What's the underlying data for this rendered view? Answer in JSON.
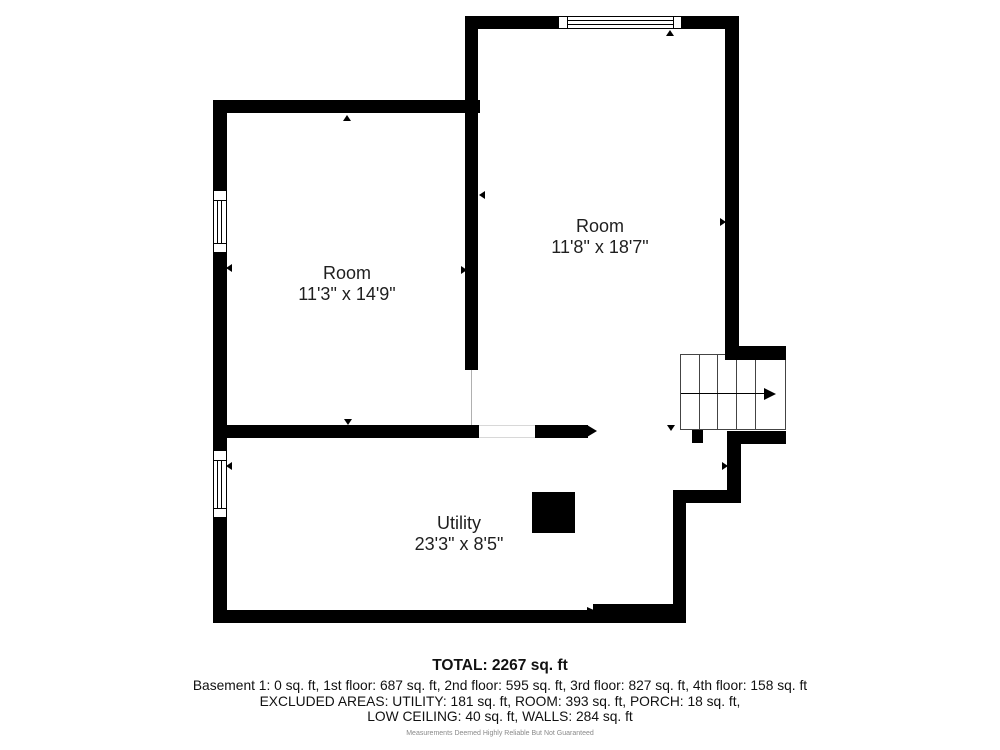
{
  "colors": {
    "wall": "#000000",
    "text": "#1f1f1f",
    "stair_line": "#444444",
    "opening_line": "#d8d8d8",
    "disclaimer": "#8a8a8a",
    "background": "#ffffff"
  },
  "rooms": [
    {
      "name": "Room",
      "dimensions": "11'3\" x 14'9\""
    },
    {
      "name": "Room",
      "dimensions": "11'8\" x 18'7\""
    },
    {
      "name": "Utility",
      "dimensions": "23'3\" x 8'5\""
    }
  ],
  "summary": {
    "total": "TOTAL: 2267 sq. ft",
    "floors": "Basement 1: 0 sq. ft, 1st floor: 687 sq. ft, 2nd floor: 595 sq. ft, 3rd floor: 827 sq. ft, 4th floor: 158 sq. ft",
    "excluded_line1": "EXCLUDED AREAS: UTILITY: 181 sq. ft, ROOM: 393 sq. ft, PORCH: 18 sq. ft,",
    "excluded_line2": "LOW CEILING: 40 sq. ft, WALLS: 284 sq. ft",
    "disclaimer": "Measurements Deemed Highly Reliable But Not Guaranteed"
  },
  "plan": {
    "rects": [
      {
        "name": "wall-left-upper",
        "x": 213,
        "y": 100,
        "w": 14,
        "h": 90,
        "c": "#000000"
      },
      {
        "name": "wall-left-mid",
        "x": 213,
        "y": 253,
        "w": 14,
        "h": 197,
        "c": "#000000"
      },
      {
        "name": "wall-left-lower",
        "x": 213,
        "y": 518,
        "w": 14,
        "h": 105,
        "c": "#000000"
      },
      {
        "name": "wall-top-left-room",
        "x": 213,
        "y": 100,
        "w": 267,
        "h": 13,
        "c": "#000000"
      },
      {
        "name": "wall-middle-vertical",
        "x": 465,
        "y": 16,
        "w": 13,
        "h": 354,
        "c": "#000000"
      },
      {
        "name": "wall-top-right-room-left",
        "x": 465,
        "y": 16,
        "w": 93,
        "h": 13,
        "c": "#000000"
      },
      {
        "name": "wall-top-right-room-right",
        "x": 682,
        "y": 16,
        "w": 56,
        "h": 13,
        "c": "#000000"
      },
      {
        "name": "wall-right",
        "x": 725,
        "y": 16,
        "w": 14,
        "h": 344,
        "c": "#000000"
      },
      {
        "name": "wall-divider-left",
        "x": 213,
        "y": 425,
        "w": 266,
        "h": 13,
        "c": "#000000"
      },
      {
        "name": "wall-divider-right",
        "x": 535,
        "y": 425,
        "w": 53,
        "h": 13,
        "c": "#000000"
      },
      {
        "name": "wall-right-below-stairs",
        "x": 727,
        "y": 431,
        "w": 14,
        "h": 72,
        "c": "#000000"
      },
      {
        "name": "wall-jog-horizontal",
        "x": 673,
        "y": 490,
        "w": 68,
        "h": 13,
        "c": "#000000"
      },
      {
        "name": "wall-right-lower",
        "x": 673,
        "y": 490,
        "w": 13,
        "h": 133,
        "c": "#000000"
      },
      {
        "name": "wall-bottom",
        "x": 213,
        "y": 610,
        "w": 473,
        "h": 13,
        "c": "#000000"
      },
      {
        "name": "wall-bottom-step",
        "x": 593,
        "y": 604,
        "w": 80,
        "h": 8,
        "c": "#000000"
      },
      {
        "name": "door-opening-edge-top",
        "x": 479,
        "y": 425,
        "w": 56,
        "h": 1,
        "c": "#d8d8d8"
      },
      {
        "name": "door-opening-edge-bottom",
        "x": 479,
        "y": 437,
        "w": 56,
        "h": 1,
        "c": "#d8d8d8"
      },
      {
        "name": "wall-opening-line",
        "x": 471,
        "y": 370,
        "w": 1,
        "h": 55,
        "c": "#b0b0b0"
      },
      {
        "name": "stairs-floor",
        "x": 680,
        "y": 354,
        "w": 106,
        "h": 76,
        "c": "#ffffff",
        "border": "#444444"
      },
      {
        "name": "stair-tread-line",
        "x": 699,
        "y": 354,
        "w": 1,
        "h": 76,
        "c": "#444444"
      },
      {
        "name": "stair-tread-line",
        "x": 717,
        "y": 354,
        "w": 1,
        "h": 76,
        "c": "#444444"
      },
      {
        "name": "stair-tread-line",
        "x": 736,
        "y": 354,
        "w": 1,
        "h": 76,
        "c": "#444444"
      },
      {
        "name": "stair-tread-line",
        "x": 755,
        "y": 354,
        "w": 1,
        "h": 76,
        "c": "#444444"
      },
      {
        "name": "stair-direction-line",
        "x": 681,
        "y": 393,
        "w": 83,
        "h": 1,
        "c": "#000000"
      },
      {
        "name": "wall-stairwell-top",
        "x": 725,
        "y": 346,
        "w": 61,
        "h": 14,
        "c": "#000000"
      },
      {
        "name": "wall-stairwell-bottom",
        "x": 727,
        "y": 431,
        "w": 59,
        "h": 13,
        "c": "#000000"
      },
      {
        "name": "wall-stair-tab",
        "x": 692,
        "y": 430,
        "w": 11,
        "h": 13,
        "c": "#000000"
      },
      {
        "name": "chimney-block",
        "x": 532,
        "y": 492,
        "w": 43,
        "h": 41,
        "c": "#000000"
      },
      {
        "name": "window-top-frame",
        "x": 558,
        "y": 16,
        "w": 124,
        "h": 13,
        "c": "#ffffff",
        "border": "#000000"
      },
      {
        "name": "window-top-separator-left",
        "x": 567,
        "y": 16,
        "w": 1,
        "h": 13,
        "c": "#000000"
      },
      {
        "name": "window-top-separator-right",
        "x": 673,
        "y": 16,
        "w": 1,
        "h": 13,
        "c": "#000000"
      },
      {
        "name": "window-top-pane-line",
        "x": 567,
        "y": 20,
        "w": 107,
        "h": 1,
        "c": "#000000"
      },
      {
        "name": "window-top-pane-line",
        "x": 567,
        "y": 24,
        "w": 107,
        "h": 1,
        "c": "#000000"
      },
      {
        "name": "window-left-upper-frame",
        "x": 213,
        "y": 190,
        "w": 14,
        "h": 63,
        "c": "#ffffff",
        "border": "#000000"
      },
      {
        "name": "window-left-upper-separator",
        "x": 213,
        "y": 200,
        "w": 14,
        "h": 1,
        "c": "#000000"
      },
      {
        "name": "window-left-upper-separator",
        "x": 213,
        "y": 243,
        "w": 14,
        "h": 1,
        "c": "#000000"
      },
      {
        "name": "window-left-upper-pane-line",
        "x": 217,
        "y": 200,
        "w": 1,
        "h": 43,
        "c": "#000000"
      },
      {
        "name": "window-left-upper-pane-line",
        "x": 221,
        "y": 200,
        "w": 1,
        "h": 43,
        "c": "#000000"
      },
      {
        "name": "window-left-lower-frame",
        "x": 213,
        "y": 450,
        "w": 14,
        "h": 68,
        "c": "#ffffff",
        "border": "#000000"
      },
      {
        "name": "window-left-lower-separator",
        "x": 213,
        "y": 460,
        "w": 14,
        "h": 1,
        "c": "#000000"
      },
      {
        "name": "window-left-lower-separator",
        "x": 213,
        "y": 508,
        "w": 14,
        "h": 1,
        "c": "#000000"
      },
      {
        "name": "window-left-lower-pane-line",
        "x": 217,
        "y": 460,
        "w": 1,
        "h": 48,
        "c": "#000000"
      },
      {
        "name": "window-left-lower-pane-line",
        "x": 221,
        "y": 460,
        "w": 1,
        "h": 48,
        "c": "#000000"
      }
    ],
    "triangles": [
      {
        "name": "measure-arrow-up-left-room",
        "dir": "up",
        "tx": 347,
        "ty": 115,
        "w": 9,
        "h": 6
      },
      {
        "name": "measure-arrow-down-left-room",
        "dir": "down",
        "tx": 348,
        "ty": 425,
        "w": 9,
        "h": 6
      },
      {
        "name": "measure-arrow-left-left-room",
        "dir": "left",
        "tx": 226,
        "ty": 268,
        "w": 6,
        "h": 9
      },
      {
        "name": "measure-arrow-right-left-room",
        "dir": "right",
        "tx": 467,
        "ty": 270,
        "w": 6,
        "h": 9
      },
      {
        "name": "measure-arrow-left-right-room",
        "dir": "left",
        "tx": 479,
        "ty": 195,
        "w": 6,
        "h": 9
      },
      {
        "name": "measure-arrow-right-right-room",
        "dir": "right",
        "tx": 726,
        "ty": 222,
        "w": 6,
        "h": 9
      },
      {
        "name": "measure-arrow-up-right-room",
        "dir": "up",
        "tx": 670,
        "ty": 30,
        "w": 9,
        "h": 6
      },
      {
        "name": "measure-arrow-down-right-room",
        "dir": "down",
        "tx": 671,
        "ty": 431,
        "w": 9,
        "h": 6
      },
      {
        "name": "measure-arrow-left-utility",
        "dir": "left",
        "tx": 226,
        "ty": 466,
        "w": 6,
        "h": 9
      },
      {
        "name": "measure-arrow-right-utility",
        "dir": "right",
        "tx": 728,
        "ty": 466,
        "w": 6,
        "h": 9
      },
      {
        "name": "wall-end-arrowhead-divider",
        "dir": "right",
        "tx": 597,
        "ty": 431,
        "w": 10,
        "h": 13
      },
      {
        "name": "wall-end-arrowhead-bottom",
        "dir": "right",
        "tx": 596,
        "ty": 611,
        "w": 9,
        "h": 9
      },
      {
        "name": "stair-direction-arrowhead",
        "dir": "right",
        "tx": 776,
        "ty": 394,
        "w": 12,
        "h": 13
      }
    ]
  }
}
